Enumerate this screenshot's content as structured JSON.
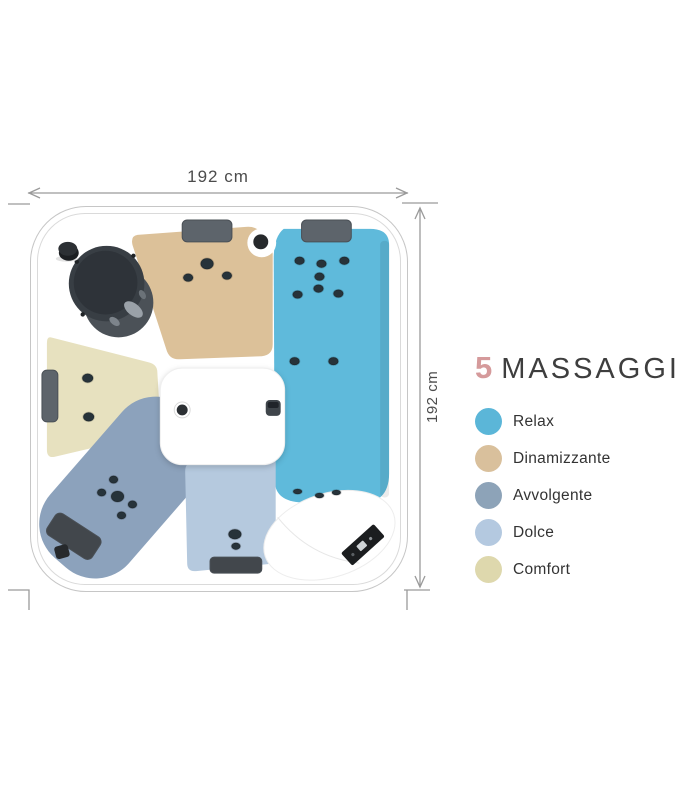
{
  "dimensions": {
    "width_label": "192 cm",
    "height_label": "192 cm"
  },
  "legend": {
    "count": "5",
    "count_color": "#d59a9b",
    "title": "MASSAGGI",
    "items": [
      {
        "label": "Relax",
        "color": "#5bb6d8"
      },
      {
        "label": "Dinamizzante",
        "color": "#d9c09c"
      },
      {
        "label": "Avvolgente",
        "color": "#8da3b8"
      },
      {
        "label": "Dolce",
        "color": "#b4c9e0"
      },
      {
        "label": "Comfort",
        "color": "#ded8ad"
      }
    ]
  },
  "zones": {
    "relax": "#5fbadb",
    "dinamizzante": "#dcc199",
    "avvolgente": "#8ca2bc",
    "dolce": "#b5c9de",
    "comfort": "#e7e1bf"
  }
}
